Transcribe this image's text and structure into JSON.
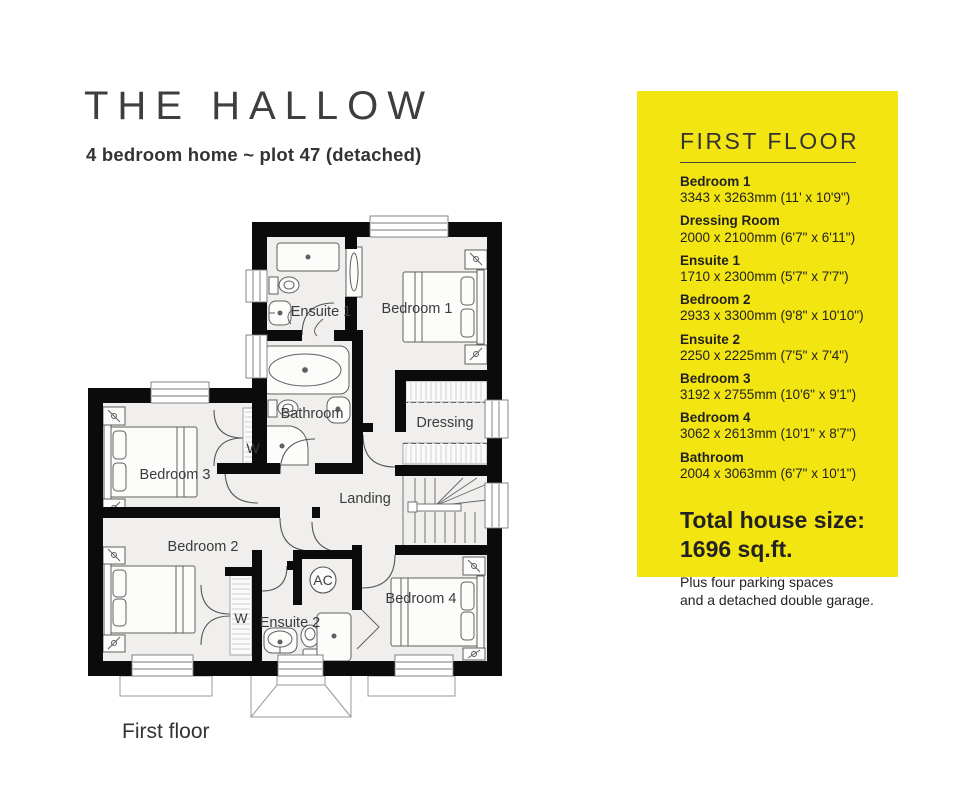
{
  "header": {
    "title": "THE HALLOW",
    "subtitle": "4 bedroom home ~ plot 47 (detached)"
  },
  "panel": {
    "bg_color": "#F3E512",
    "heading": "FIRST FLOOR",
    "rooms": [
      {
        "name": "Bedroom 1",
        "dims": "3343 x 3263mm (11' x 10'9\")"
      },
      {
        "name": "Dressing Room",
        "dims": "2000 x 2100mm (6'7\" x 6'11\")"
      },
      {
        "name": "Ensuite 1",
        "dims": "1710 x 2300mm (5'7\" x 7'7\")"
      },
      {
        "name": "Bedroom 2",
        "dims": "2933 x 3300mm (9'8\" x 10'10\")"
      },
      {
        "name": "Ensuite 2",
        "dims": "2250 x 2225mm (7'5\" x 7'4\")"
      },
      {
        "name": "Bedroom 3",
        "dims": "3192 x 2755mm (10'6\" x 9'1\")"
      },
      {
        "name": "Bedroom 4",
        "dims": "3062 x 2613mm (10'1\" x 8'7\")"
      },
      {
        "name": "Bathroom",
        "dims": "2004 x 3063mm (6'7\" x 10'1\")"
      }
    ],
    "total_label": "Total house size:",
    "total_value": "1696 sq.ft.",
    "note_line1": "Plus four parking spaces",
    "note_line2": "and a detached double garage."
  },
  "plan": {
    "caption": "First floor",
    "labels": {
      "bedroom1": "Bedroom 1",
      "ensuite1": "Ensuite 1",
      "bathroom": "Bathroom",
      "dressing": "Dressing",
      "bedroom3": "Bedroom 3",
      "bedroom2": "Bedroom 2",
      "bedroom4": "Bedroom 4",
      "ensuite2": "Ensuite 2",
      "landing": "Landing",
      "wardrobe_1": "W",
      "wardrobe_2": "W",
      "ac": "AC"
    }
  }
}
